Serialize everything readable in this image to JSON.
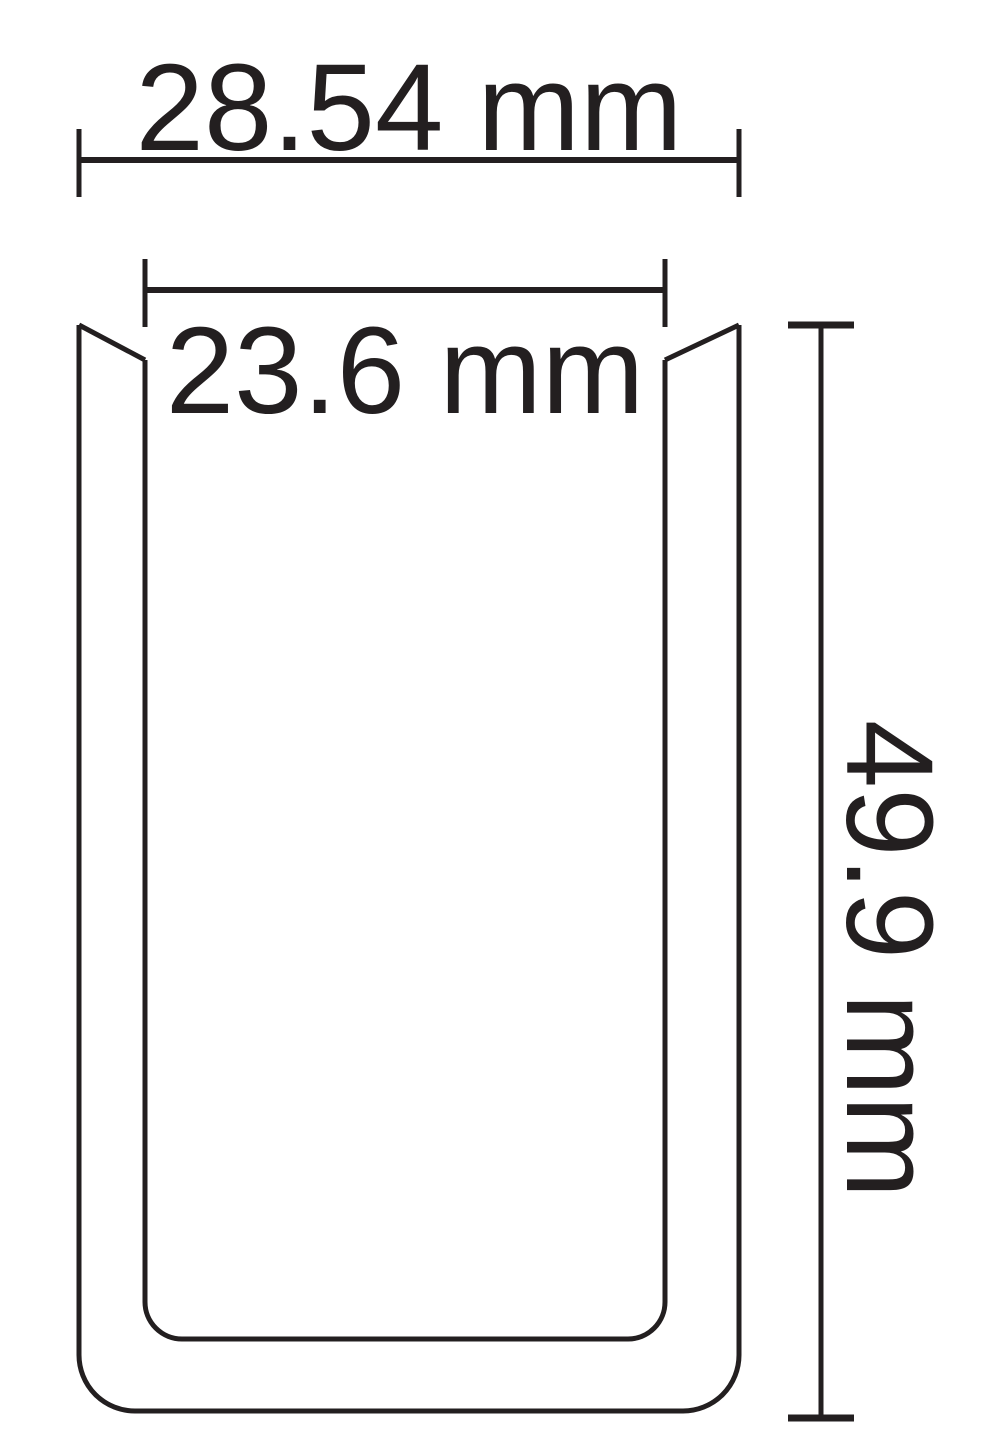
{
  "colors": {
    "line": "#231f20",
    "background": "#ffffff"
  },
  "drawing": {
    "type": "technical-cross-section",
    "shape": "u-channel-profile",
    "dimensions": {
      "outer_width": {
        "label": "28.54 mm"
      },
      "inner_width": {
        "label": "23.6 mm"
      },
      "height": {
        "label": "49.9 mm"
      }
    }
  }
}
